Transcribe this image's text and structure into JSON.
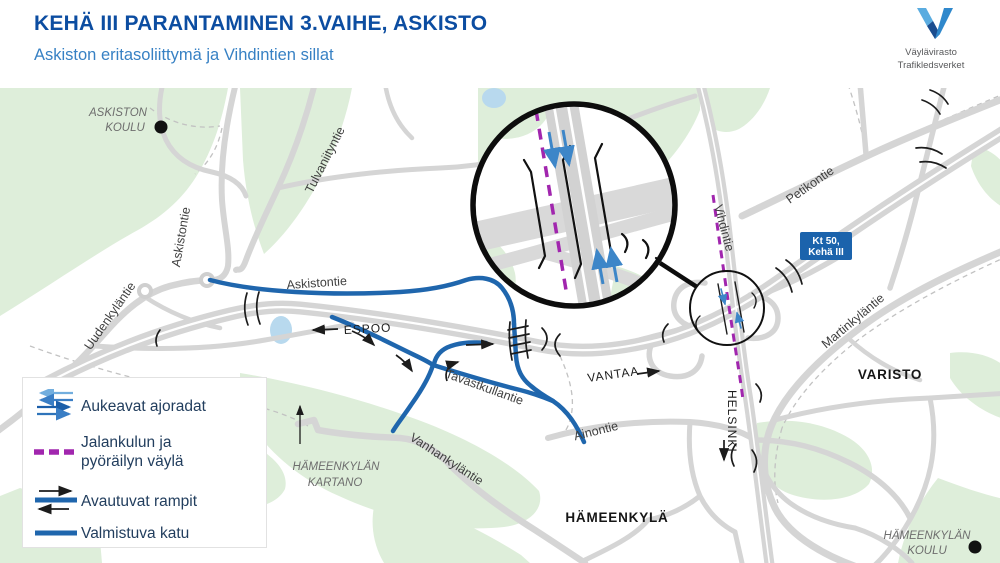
{
  "header": {
    "title": "KEHÄ III PARANTAMINEN 3.VAIHE, ASKISTO",
    "subtitle": "Askiston eritasoliittymä ja Vihdintien sillat",
    "logo": {
      "line1": "Väylävirasto",
      "line2": "Trafikledsverket"
    }
  },
  "legend": {
    "items": [
      {
        "icon": "opening-carriageways-arrows-icon",
        "label": "Aukeavat ajoradat"
      },
      {
        "icon": "pedestrian-cycleway-dash-icon",
        "label": "Jalankulun ja pyöräilyn väylä",
        "label_line1": "Jalankulun ja",
        "label_line2": "pyöräilyn väylä"
      },
      {
        "icon": "opening-ramps-icon",
        "label": "Avautuvat rampit"
      },
      {
        "icon": "completing-street-icon",
        "label": "Valmistuva katu"
      }
    ]
  },
  "map": {
    "labels": {
      "askiston_koulu_line1": "ASKISTON",
      "askiston_koulu_line2": "KOULU",
      "tulvaniityntie": "Tulvaniityntie",
      "askistontie_vertical": "Askistontie",
      "uudenkylantie": "Uudenkyläntie",
      "askistontie": "Askistontie",
      "espoo": "ESPOO",
      "vantaa": "VANTAA",
      "helsinki": "HELSINKI",
      "tavastkullantie": "Tavastkullantie",
      "vanhankylantie": "Vanhankyläntie",
      "hameenkylan_kartano_line1": "HÄMEENKYLÄN",
      "hameenkylan_kartano_line2": "KARTANO",
      "ainontie": "Ainontie",
      "hameenkyla": "HÄMEENKYLÄ",
      "vihdintie": "Vihdintie",
      "petikontie": "Petikontie",
      "martinkylantie": "Martinkyläntie",
      "varisto": "VARISTO",
      "hameenkylan_koulu_line1": "HÄMEENKYLÄN",
      "hameenkylan_koulu_line2": "KOULU"
    },
    "badge": {
      "line1": "Kt 50,",
      "line2": "Kehä III"
    }
  },
  "colors": {
    "title_blue": "#0c4da1",
    "subtitle_blue": "#3781c4",
    "road_blue": "#1f66ad",
    "arrow_blue": "#3d86c8",
    "pedestrian_purple": "#a126ae",
    "badge_blue": "#1b63ac",
    "map_green": "#deeeda",
    "road_gray": "#d5d5d5",
    "water_blue": "#b8d9ee"
  }
}
